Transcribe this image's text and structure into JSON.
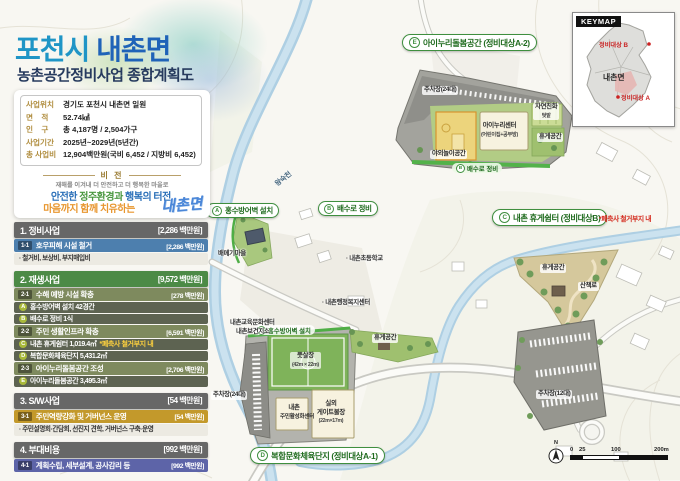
{
  "header": {
    "title1": "포천시",
    "title2": "내촌면",
    "subtitle": "농촌공간정비사업 종합계획도"
  },
  "info": {
    "rows": [
      {
        "label": "사업위치",
        "value": "경기도 포천시 내촌면 일원"
      },
      {
        "label": "면    적",
        "value": "52.74㎢"
      },
      {
        "label": "인    구",
        "value": "총 4,187명 / 2,504가구"
      },
      {
        "label": "사업기간",
        "value": "2025년~2029년(5년간)"
      },
      {
        "label": "총 사업비",
        "value": "12,904백만원(국비 6,452 / 지방비 6,452)"
      }
    ]
  },
  "vision": {
    "heading": "비 전",
    "tagline": "재해를 이겨내 더 안전하고 더 행복한 마을로",
    "l1a": "안전한",
    "l1b": " 정주환경과",
    "l1c": " 행복의 터전,",
    "l2": "마음까지 함께 치유하는",
    "logo": "내촌면"
  },
  "programs": {
    "sec1": {
      "title": "1. 정비사업",
      "cost": "[2,286 백만원]"
    },
    "sub11": {
      "badge": "1-1",
      "title": "호우피해 시설 철거",
      "cost": "[2,286 백만원]"
    },
    "note1": "· 철거비, 보상비, 부지매입비",
    "sec2": {
      "title": "2. 재생사업",
      "cost": "[9,572 백만원]"
    },
    "sub21": {
      "badge": "2-1",
      "title": "수해 예방 시설 확충",
      "cost": "[278 백만원]"
    },
    "itemA": {
      "letter": "A",
      "text": "홍수방어벽 설치 42경간"
    },
    "itemB": {
      "letter": "B",
      "text": "배수로 정비 1식"
    },
    "sub22": {
      "badge": "2-2",
      "title": "주민 생활인프라 확충",
      "cost": "[6,591 백만원]"
    },
    "itemC": {
      "letter": "C",
      "text": "내촌 휴게쉼터 1,019.4㎡",
      "warn": "*폐축사 철거부지 내"
    },
    "itemD": {
      "letter": "D",
      "text": "복합문화체육단지 5,431.2㎡"
    },
    "sub23": {
      "badge": "2-3",
      "title": "아이누리돌봄공간 조성",
      "cost": "[2,706 백만원]"
    },
    "itemE": {
      "letter": "E",
      "text": "아이누리돌봄공간 3,495.3㎡"
    },
    "sec3": {
      "title": "3. S/W사업",
      "cost": "[54 백만원]"
    },
    "sub31": {
      "badge": "3-1",
      "title": "주민역량강화 및 거버넌스 운영",
      "cost": "[54 백만원]"
    },
    "note3": "· 주민설명회·간담회, 선진지 견학, 거버넌스 구축·운영",
    "sec4": {
      "title": "4. 부대비용",
      "cost": "[992 백만원]"
    },
    "sub41": {
      "badge": "4-1",
      "title": "계획수립, 세부설계, 공사감리 등",
      "cost": "[992 백만원]"
    }
  },
  "callouts": {
    "a": {
      "letter": "A",
      "text": "홍수방어벽 설치"
    },
    "b": {
      "letter": "B",
      "text": "배수로 정비"
    },
    "c": {
      "letter": "C",
      "text": "내촌 휴게쉼터 (정비대상B)",
      "warn": "*폐축사 철거부지 내"
    },
    "d": {
      "letter": "D",
      "text": "복합문화체육단지 (정비대상A-1)"
    },
    "e": {
      "letter": "E",
      "text": "아이누리돌봄공간 (정비대상A-2)"
    }
  },
  "site_e": {
    "parking": "주차장(24대)",
    "garden1": "자연친화",
    "garden2": "텃밭",
    "center": "아이누리센터",
    "center_sub": "(어린이집+공부방)",
    "rest": "휴게공간",
    "play": "야외놀이공간",
    "drain_letter": "B",
    "drain": "배수로 정비"
  },
  "site_c": {
    "rest": "휴게공간",
    "trail": "산책로",
    "parking": "주차장(12대)"
  },
  "site_d": {
    "wall_letter": "A",
    "wall": "홍수방어벽 설치",
    "futsal": "풋살장",
    "futsal_dim": "(42m × 22m)",
    "rest": "휴게공간",
    "gate1": "실외",
    "gate2": "게이트볼장",
    "gate_dim": "(22m×17m)",
    "center1": "내촌",
    "center2": "주민활성화센터",
    "parking": "주차장(24대)"
  },
  "map_labels": {
    "river": "왕숙천",
    "village": "배메기마을",
    "school": "· 내촌초등학교",
    "office": "· 내촌행정복지센터",
    "edu": "내촌교육문화센터",
    "health": "내촌보건지소"
  },
  "keymap": {
    "title": "KEYMAP",
    "region": "내촌면",
    "target_a": "정비대상 A",
    "target_b": "정비대상 B"
  },
  "scalebar": {
    "n": "N",
    "t0": "0",
    "t1": "25",
    "t2": "100",
    "t3": "200m"
  }
}
